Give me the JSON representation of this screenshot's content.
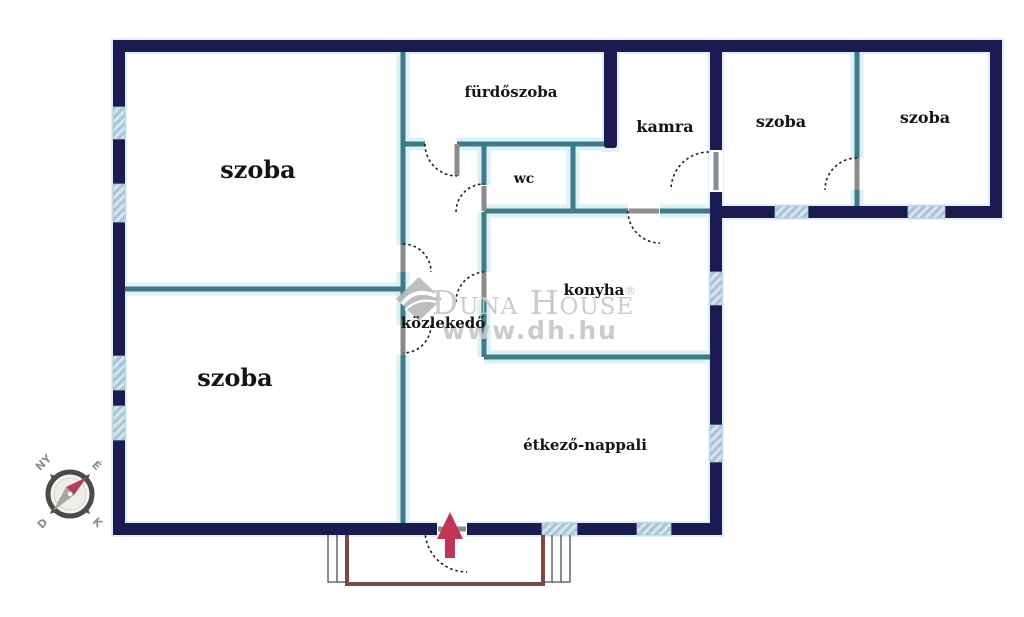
{
  "rooms": {
    "szoba1": "szoba",
    "szoba2": "szoba",
    "bathroom": "fürdőszoba",
    "wc": "wc",
    "pantry": "kamra",
    "kitchen": "konyha",
    "hallway": "közlekedő",
    "living": "étkező-nappali",
    "szoba3": "szoba",
    "szoba4": "szoba"
  },
  "watermark": {
    "brand": "Duna House",
    "registered": "®",
    "url": "www.dh.hu"
  },
  "compass": {
    "west": "NY",
    "north": "É",
    "south": "D",
    "east": "K"
  },
  "colors": {
    "wallOuter": "#1b1b51",
    "wallInner": "#3f7a87",
    "wallGlow": "#dbf0f7",
    "windowFill": "#d6e5ee",
    "windowHatch": "#a9c4d2",
    "doorLeaf": "#8b8b8b",
    "arcColor": "#1f1f1f",
    "accentRed": "#c23455",
    "needleRed": "#b53e58",
    "needleGray": "#a8a4a0",
    "porchBrown": "#7d4a42",
    "stepGray": "#4e4e4e",
    "watermarkGray": "#c7c7c7",
    "logoGray": "#b9b9b9",
    "labelColor": "#141414",
    "compassDark": "#4b4b4b",
    "compassFace": "#f5f3ef"
  }
}
